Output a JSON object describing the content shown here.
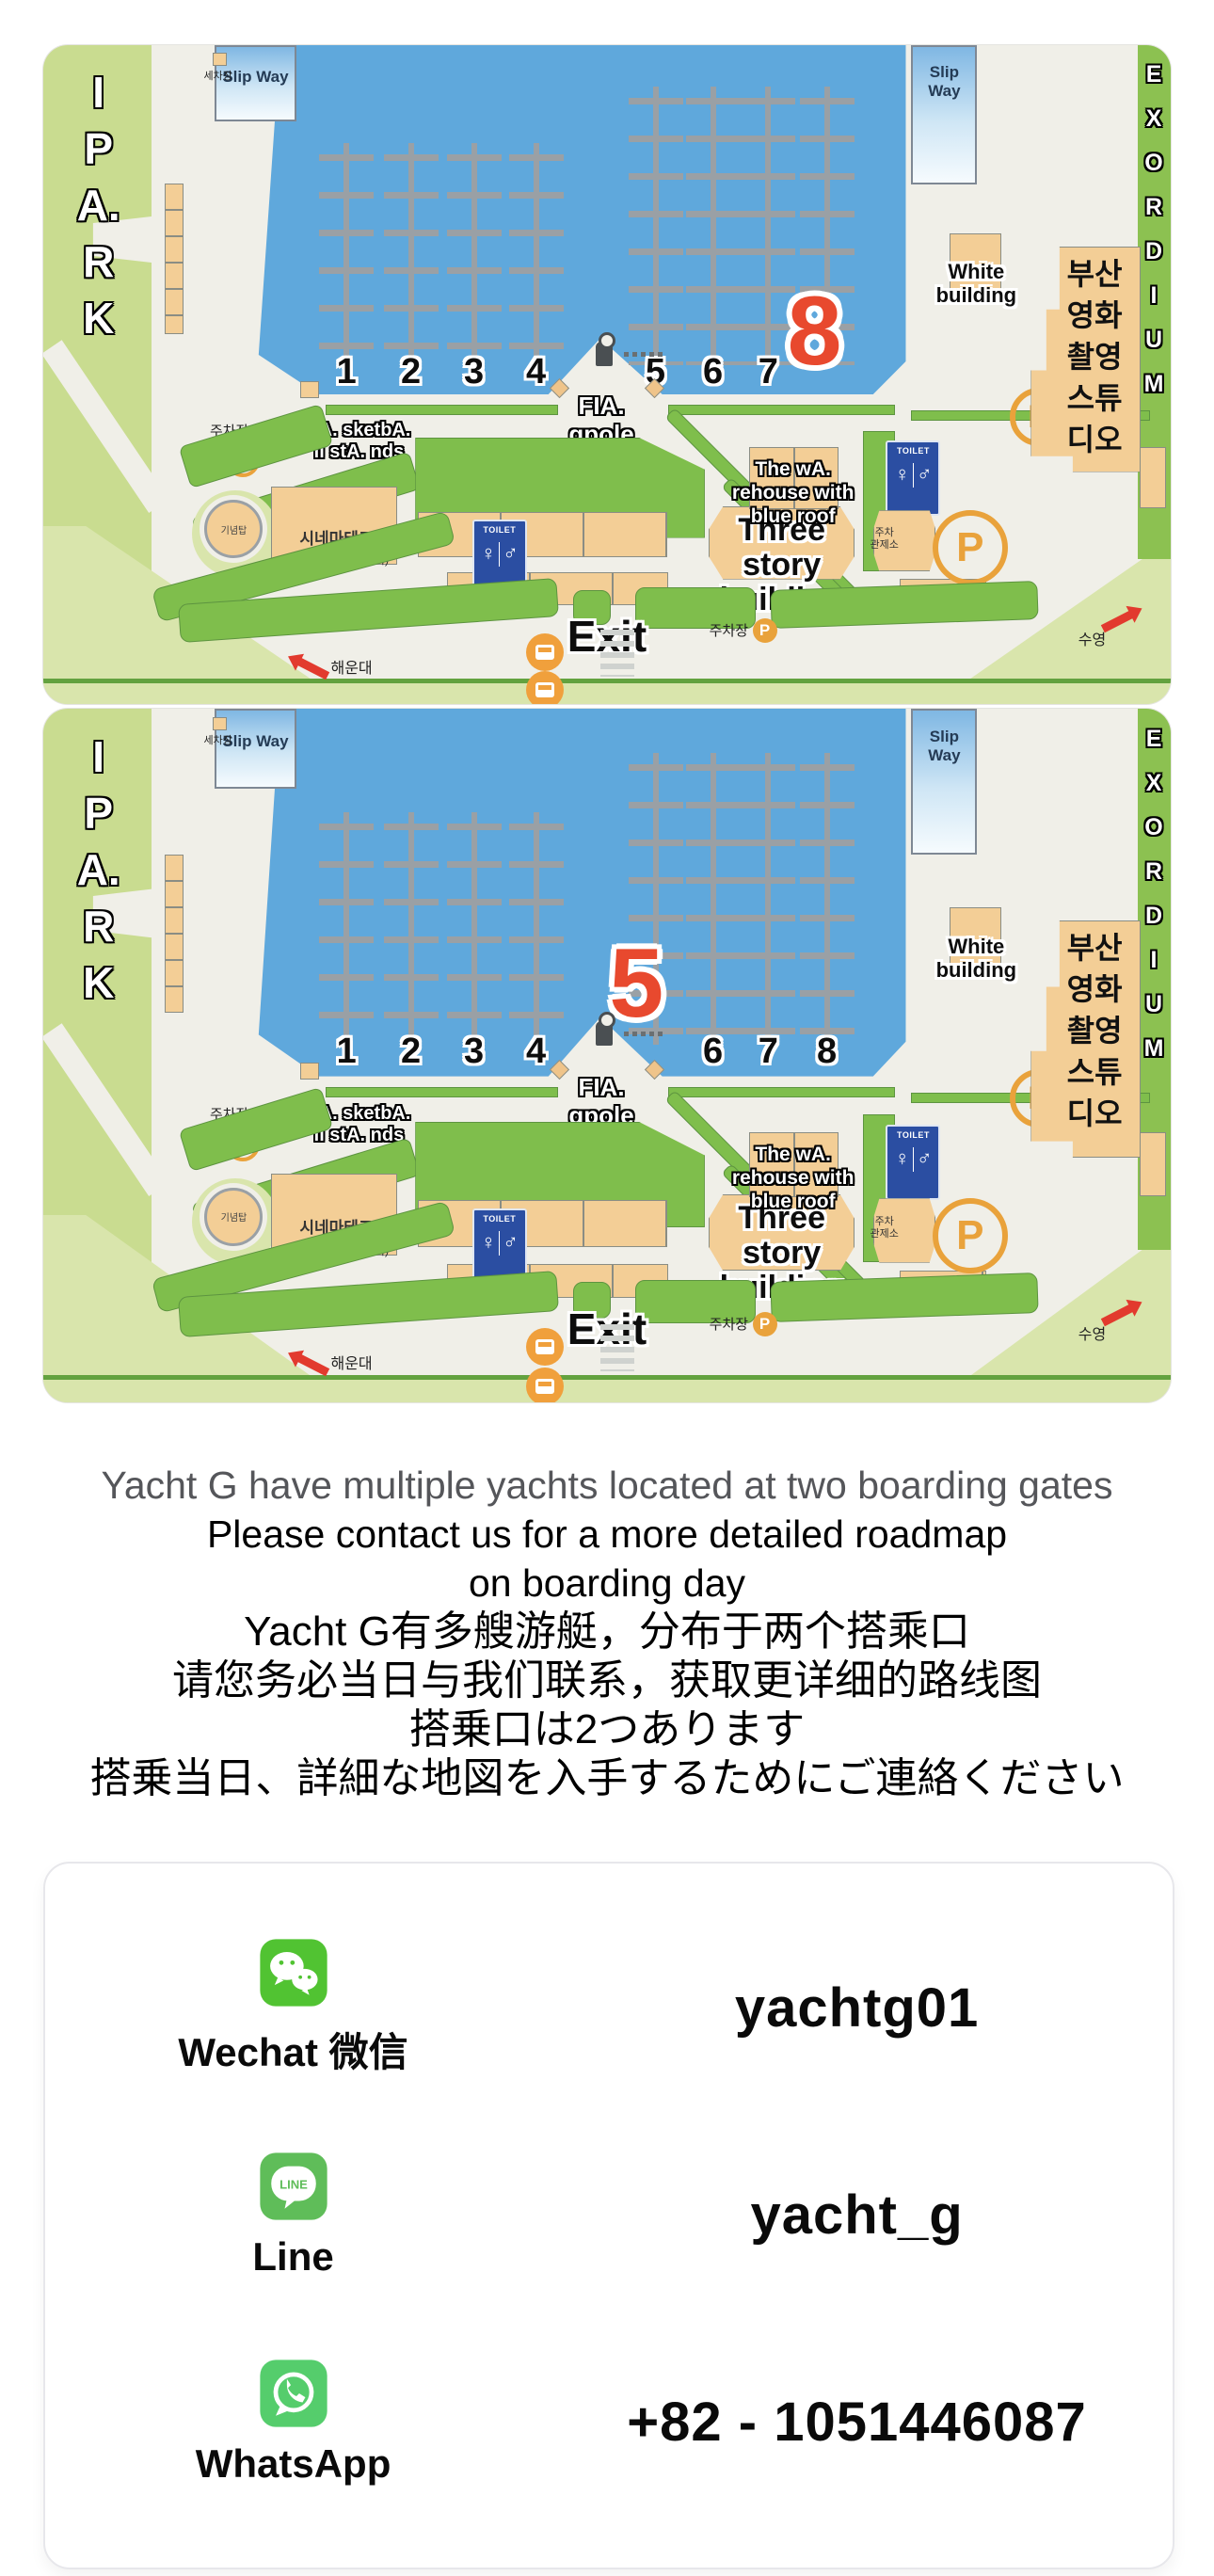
{
  "map_labels": {
    "ipark": [
      "I",
      "P",
      "A.",
      "R",
      "K"
    ],
    "exordium": [
      "E",
      "X",
      "O",
      "R",
      "D",
      "I",
      "U",
      "M"
    ],
    "slip_way": "Slip Way",
    "car_wash": "세차장",
    "white_building": [
      "White",
      "building"
    ],
    "fia": [
      "FIA.",
      "gpole"
    ],
    "squre": "Squre",
    "basketball": [
      "bA. sketbA.",
      "ll stA. nds"
    ],
    "warehouse": [
      "The wA.",
      "rehouse with",
      "blue roof"
    ],
    "three_story": [
      "Three",
      "story",
      "building"
    ],
    "exit": "Exit",
    "toilet": "TOILET",
    "toilet_glyphs": "♀",
    "toilet_glyphs2": "♂",
    "p": "P",
    "studio": [
      "부산",
      "영화",
      "촬영",
      "스튜",
      "디오"
    ],
    "parking": "주차장",
    "parking_control": [
      "주차",
      "관제소"
    ],
    "monument": "기념탑",
    "cinematheque": "시네마테크",
    "community_center": "(우3동지역주민센터)",
    "haeundae": "해운대",
    "suyeong": "수영"
  },
  "maps": [
    {
      "name": "Boarding gate 8 map",
      "highlighted_gate": "8",
      "big_number": "8",
      "dock_numbers": [
        "1",
        "2",
        "3",
        "4",
        "5",
        "6",
        "7"
      ]
    },
    {
      "name": "Boarding gate 5 map",
      "highlighted_gate": "5",
      "big_number": "5",
      "dock_numbers": [
        "1",
        "2",
        "3",
        "4",
        "6",
        "7",
        "8"
      ]
    }
  ],
  "notice": {
    "lines": [
      "Yacht G have multiple yachts located at two boarding gates",
      "Please contact us for a more detailed roadmap",
      "on boarding day",
      "Yacht G有多艘游艇，分布于两个搭乘口",
      "请您务必当日与我们联系，获取更详细的路线图",
      "搭乗口は2つあります",
      "搭乗当日、詳細な地図を入手するためにご連絡ください"
    ]
  },
  "contact": {
    "rows": [
      {
        "app": "Wechat 微信",
        "value": "yachtg01",
        "icon": "wechat"
      },
      {
        "app": "Line",
        "value": "yacht_g",
        "icon": "line"
      },
      {
        "app": "WhatsApp",
        "value": "+82 - 1051446087",
        "icon": "whatsapp"
      }
    ]
  },
  "colors": {
    "water": "#5FA8DC",
    "land": "#F0EFE8",
    "green": "#7FBE4C",
    "pale_green": "#C9DC90",
    "tan": "#F3CE96",
    "highlight_red": "#E8492E",
    "parking_orange": "#E9A23B",
    "toilet_blue": "#2B4EA2",
    "wechat_green": "#51C332",
    "line_green": "#5FBD59",
    "whatsapp_green": "#55CD6C"
  }
}
